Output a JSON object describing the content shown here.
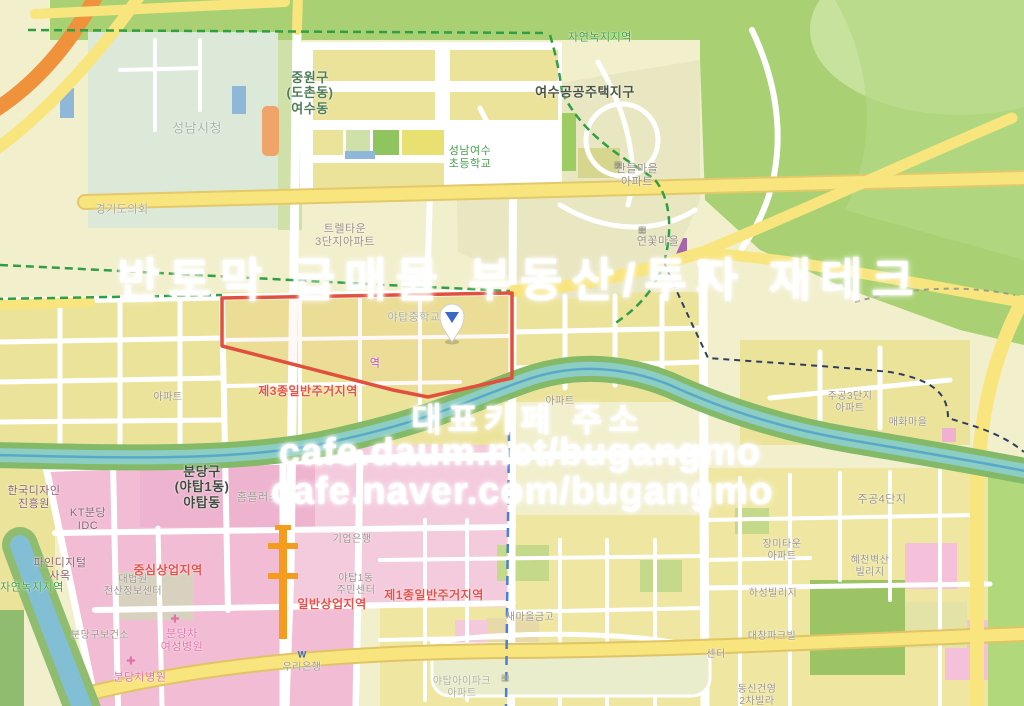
{
  "map": {
    "watermark": {
      "line1": "반토막 급매물 부동산/투자 재테크",
      "line2": "대표카페 주소",
      "line3": "cafe.daum.net/bugangmo",
      "line4": "cafe.naver.com/bugangmo"
    },
    "colors": {
      "zone_residential": "#ece39b",
      "zone_commercial_pink": "#f1bcd4",
      "zone_green": "#a9d173",
      "river_water": "#8ccdc4",
      "parcel_outline_red": "#e0503c",
      "boundary_green_dash": "#2f9e44",
      "boundary_navy_dash": "#2e3f5e",
      "subway_blue_dash": "#4a7fd4",
      "rail_orange": "#f59b1e",
      "zone_label_red": "#e85048",
      "map_label_green": "#3aa040",
      "pin_blue": "#3a66c8"
    },
    "labels": [
      {
        "id": "jayeon-nokji-top",
        "text": "자연녹지지역",
        "x": 600,
        "y": 38,
        "color": "#3aa040",
        "size": 11,
        "bold": false
      },
      {
        "id": "jungwon-gu-yeosu-dong",
        "text": "중원구\n(도촌동)\n여수동",
        "x": 310,
        "y": 93,
        "color": "#4e7d56",
        "size": 13,
        "bold": true
      },
      {
        "id": "yeosu-public-housing",
        "text": "여수공공주택지구",
        "x": 585,
        "y": 92,
        "color": "#4a5540",
        "size": 13,
        "bold": true
      },
      {
        "id": "seongnam-cityhall",
        "text": "성남시청",
        "x": 197,
        "y": 128,
        "color": "#a3b5a6",
        "size": 13,
        "bold": false
      },
      {
        "id": "gyeonggi-council",
        "text": "경기도의회",
        "x": 122,
        "y": 210,
        "color": "#aaa88e",
        "size": 11,
        "bold": false
      },
      {
        "id": "seongnam-yeosu-elementary",
        "text": "성남여수\n초등학교",
        "x": 470,
        "y": 158,
        "color": "#44a04c",
        "size": 11,
        "bold": false
      },
      {
        "id": "sandeul-maeul-apt",
        "text": "산들마을\n아파트",
        "x": 637,
        "y": 176,
        "color": "#989182",
        "size": 11,
        "bold": false
      },
      {
        "id": "trel-town-3danji",
        "text": "트렐타운\n3단지아파트",
        "x": 345,
        "y": 236,
        "color": "#989182",
        "size": 11,
        "bold": false
      },
      {
        "id": "yeonkkot-maeul",
        "text": "연꽃마을",
        "x": 658,
        "y": 242,
        "color": "#989182",
        "size": 11,
        "bold": false
      },
      {
        "id": "yatap-middle-school",
        "text": "야탑중학교",
        "x": 414,
        "y": 318,
        "color": "#a9ae9c",
        "size": 11,
        "bold": false
      },
      {
        "id": "station-partial",
        "text": "역",
        "x": 375,
        "y": 364,
        "color": "#c048c0",
        "size": 11,
        "bold": false
      },
      {
        "id": "zone-3-residential",
        "text": "제3종일반주거지역",
        "x": 308,
        "y": 391,
        "color": "#e85048",
        "size": 12,
        "bold": true
      },
      {
        "id": "apt-west",
        "text": "아파트",
        "x": 168,
        "y": 398,
        "color": "#9a9488",
        "size": 10,
        "bold": false
      },
      {
        "id": "apt-mid",
        "text": "아파트",
        "x": 560,
        "y": 402,
        "color": "#9a9488",
        "size": 10,
        "bold": false
      },
      {
        "id": "jugong-3danji-apt",
        "text": "주공3단지\n아파트",
        "x": 850,
        "y": 403,
        "color": "#9a9488",
        "size": 10,
        "bold": false
      },
      {
        "id": "maehwa-maeul",
        "text": "매화마을",
        "x": 908,
        "y": 423,
        "color": "#9a9488",
        "size": 10,
        "bold": false
      },
      {
        "id": "jugong-4danji",
        "text": "주공4단지",
        "x": 882,
        "y": 500,
        "color": "#9a9488",
        "size": 11,
        "bold": false
      },
      {
        "id": "bundang-gu-yatap-dong",
        "text": "분당구\n(야탑1동)\n야탑동",
        "x": 202,
        "y": 487,
        "color": "#3f4a3f",
        "size": 13,
        "bold": true
      },
      {
        "id": "homeplus",
        "text": "홈플러스",
        "x": 258,
        "y": 498,
        "color": "#9a9488",
        "size": 11,
        "bold": false
      },
      {
        "id": "korea-design-agency",
        "text": "한국디자인\n진흥원",
        "x": 34,
        "y": 498,
        "color": "#8a6070",
        "size": 11,
        "bold": false
      },
      {
        "id": "kt-bundang-idc",
        "text": "KT분당\nIDC",
        "x": 88,
        "y": 520,
        "color": "#8a6070",
        "size": 11,
        "bold": false
      },
      {
        "id": "fine-digital",
        "text": "파인디지털\n사옥",
        "x": 60,
        "y": 570,
        "color": "#8a6070",
        "size": 11,
        "bold": false
      },
      {
        "id": "court-data-center",
        "text": "대법원\n전산정보센터",
        "x": 133,
        "y": 586,
        "color": "#9a948a",
        "size": 10,
        "bold": false
      },
      {
        "id": "jungsim-commercial",
        "text": "중심상업지역",
        "x": 168,
        "y": 570,
        "color": "#e85048",
        "size": 12,
        "bold": true
      },
      {
        "id": "ilban-commercial",
        "text": "일반상업지역",
        "x": 332,
        "y": 604,
        "color": "#e85048",
        "size": 12,
        "bold": true
      },
      {
        "id": "yatap1-community-center",
        "text": "야탑1동\n주민센터",
        "x": 356,
        "y": 585,
        "color": "#9a948a",
        "size": 10,
        "bold": false
      },
      {
        "id": "ibk-bank",
        "text": "기업은행",
        "x": 352,
        "y": 540,
        "color": "#9a948a",
        "size": 10,
        "bold": false
      },
      {
        "id": "health-center",
        "text": "분당구보건소",
        "x": 100,
        "y": 636,
        "color": "#9a948a",
        "size": 10,
        "bold": false
      },
      {
        "id": "cha-womens-hospital",
        "text": "분당차\n여성병원",
        "x": 182,
        "y": 641,
        "color": "#e070a8",
        "size": 11,
        "bold": false
      },
      {
        "id": "cha-hospital",
        "text": "분당차병원",
        "x": 140,
        "y": 678,
        "color": "#e070a8",
        "size": 11,
        "bold": false
      },
      {
        "id": "woori-bank",
        "text": "우리은행",
        "x": 302,
        "y": 668,
        "color": "#9a948a",
        "size": 10,
        "bold": false
      },
      {
        "id": "zone-1-residential",
        "text": "제1종일반주거지역",
        "x": 434,
        "y": 595,
        "color": "#e85048",
        "size": 12,
        "bold": true
      },
      {
        "id": "saemaul-geumgo",
        "text": "새마을금고",
        "x": 530,
        "y": 618,
        "color": "#9a948a",
        "size": 10,
        "bold": false
      },
      {
        "id": "yatap-ipark-apt",
        "text": "야탑아이파크\n아파트",
        "x": 462,
        "y": 688,
        "color": "#b0b098",
        "size": 10,
        "bold": false
      },
      {
        "id": "jangmi-town-apt",
        "text": "장미타운\n아파트",
        "x": 782,
        "y": 551,
        "color": "#9a948a",
        "size": 10,
        "bold": false
      },
      {
        "id": "byeoksan-village",
        "text": "혜천벽산\n빌리지",
        "x": 870,
        "y": 567,
        "color": "#9a948a",
        "size": 10,
        "bold": false
      },
      {
        "id": "haseong-village",
        "text": "하성빌리지",
        "x": 773,
        "y": 594,
        "color": "#9a948a",
        "size": 10,
        "bold": false
      },
      {
        "id": "daechang-parkvill",
        "text": "대창파크빌",
        "x": 772,
        "y": 637,
        "color": "#9a948a",
        "size": 10,
        "bold": false
      },
      {
        "id": "center-partial",
        "text": "센터",
        "x": 716,
        "y": 655,
        "color": "#9a948a",
        "size": 10,
        "bold": false
      },
      {
        "id": "dongshin-villa",
        "text": "동신건영\n2차빌라",
        "x": 757,
        "y": 696,
        "color": "#9a948a",
        "size": 10,
        "bold": false
      },
      {
        "id": "jayeon-nokji-west",
        "text": "자연녹지지역",
        "x": 32,
        "y": 588,
        "color": "#3aa040",
        "size": 11,
        "bold": false
      }
    ],
    "icons": [
      {
        "id": "medical-cross-icon-1",
        "glyph": "✚",
        "x": 175,
        "y": 620,
        "color": "#e070a8",
        "size": 11
      },
      {
        "id": "medical-cross-icon-2",
        "glyph": "✚",
        "x": 131,
        "y": 662,
        "color": "#e070a8",
        "size": 11
      },
      {
        "id": "bank-logo-icon",
        "glyph": "W",
        "x": 302,
        "y": 655,
        "color": "#3a66c8",
        "size": 9
      },
      {
        "id": "school-building-icon-1",
        "glyph": "▦",
        "x": 618,
        "y": 165,
        "color": "#8a8a7a",
        "size": 9
      },
      {
        "id": "school-building-icon-2",
        "glyph": "▦",
        "x": 642,
        "y": 230,
        "color": "#8a8a7a",
        "size": 9
      },
      {
        "id": "building-icon-3",
        "glyph": "▦",
        "x": 505,
        "y": 678,
        "color": "#a0a090",
        "size": 9
      }
    ]
  }
}
